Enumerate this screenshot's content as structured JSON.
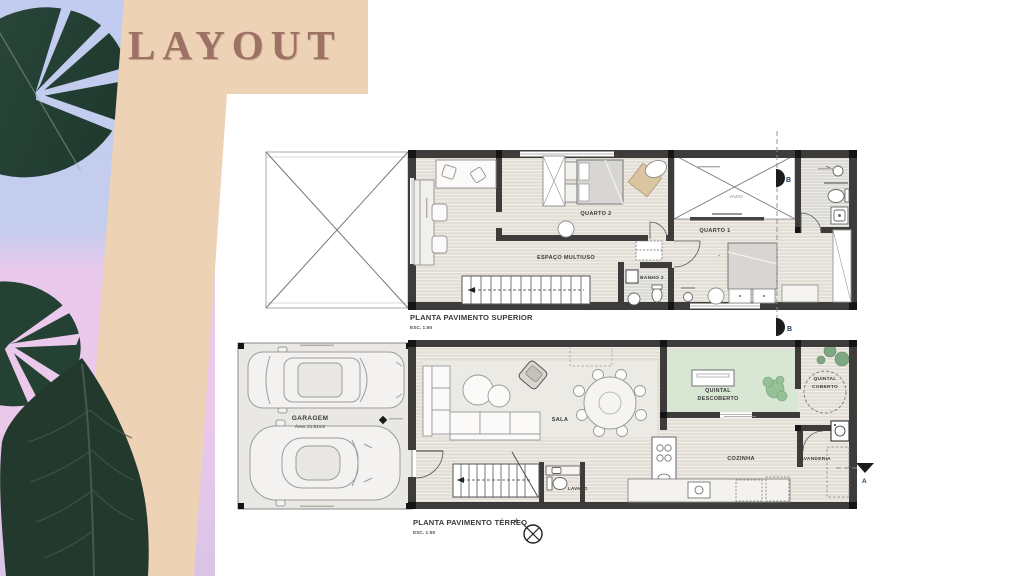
{
  "slide": {
    "title": "LAYOUT"
  },
  "upper_plan": {
    "title": "PLANTA PAVIMENTO SUPERIOR",
    "scale": "ESC. 1:50",
    "labels": {
      "quarto2": "QUARTO 2",
      "espaco_multiuso": "ESPAÇO MULTIUSO",
      "vazio": "VAZIO",
      "quarto1": "QUARTO 1",
      "banho2": "BANHO 2",
      "section_top": "B",
      "section_bottom": "B"
    }
  },
  "ground_plan": {
    "title": "PLANTA PAVIMENTO TÉRREO",
    "scale": "ESC. 1:50",
    "labels": {
      "garagem": "GARAGEM",
      "garagem_area": "Área: 21,51m2",
      "sala": "SALA",
      "lavabo": "LAVABO",
      "cozinha": "COZINHA",
      "lavanderia": "LAVANDERIA",
      "quintal_descoberto_line1": "QUINTAL",
      "quintal_descoberto_line2": "DESCOBERTO",
      "quintal_coberto_line1": "QUINTAL",
      "quintal_coberto_line2": "COBERTO",
      "section_a": "A",
      "north": "N"
    }
  },
  "colors": {
    "beige_panel": "#edd2b5",
    "title_text": "#9d7164",
    "leaf_green": "#27413a",
    "gradient_top": "#c1ccf0",
    "gradient_pink": "#ecc9ec",
    "wall": "#3d3c3a",
    "floor": "#e2ddd5",
    "garden_green": "#d8e7d3"
  }
}
